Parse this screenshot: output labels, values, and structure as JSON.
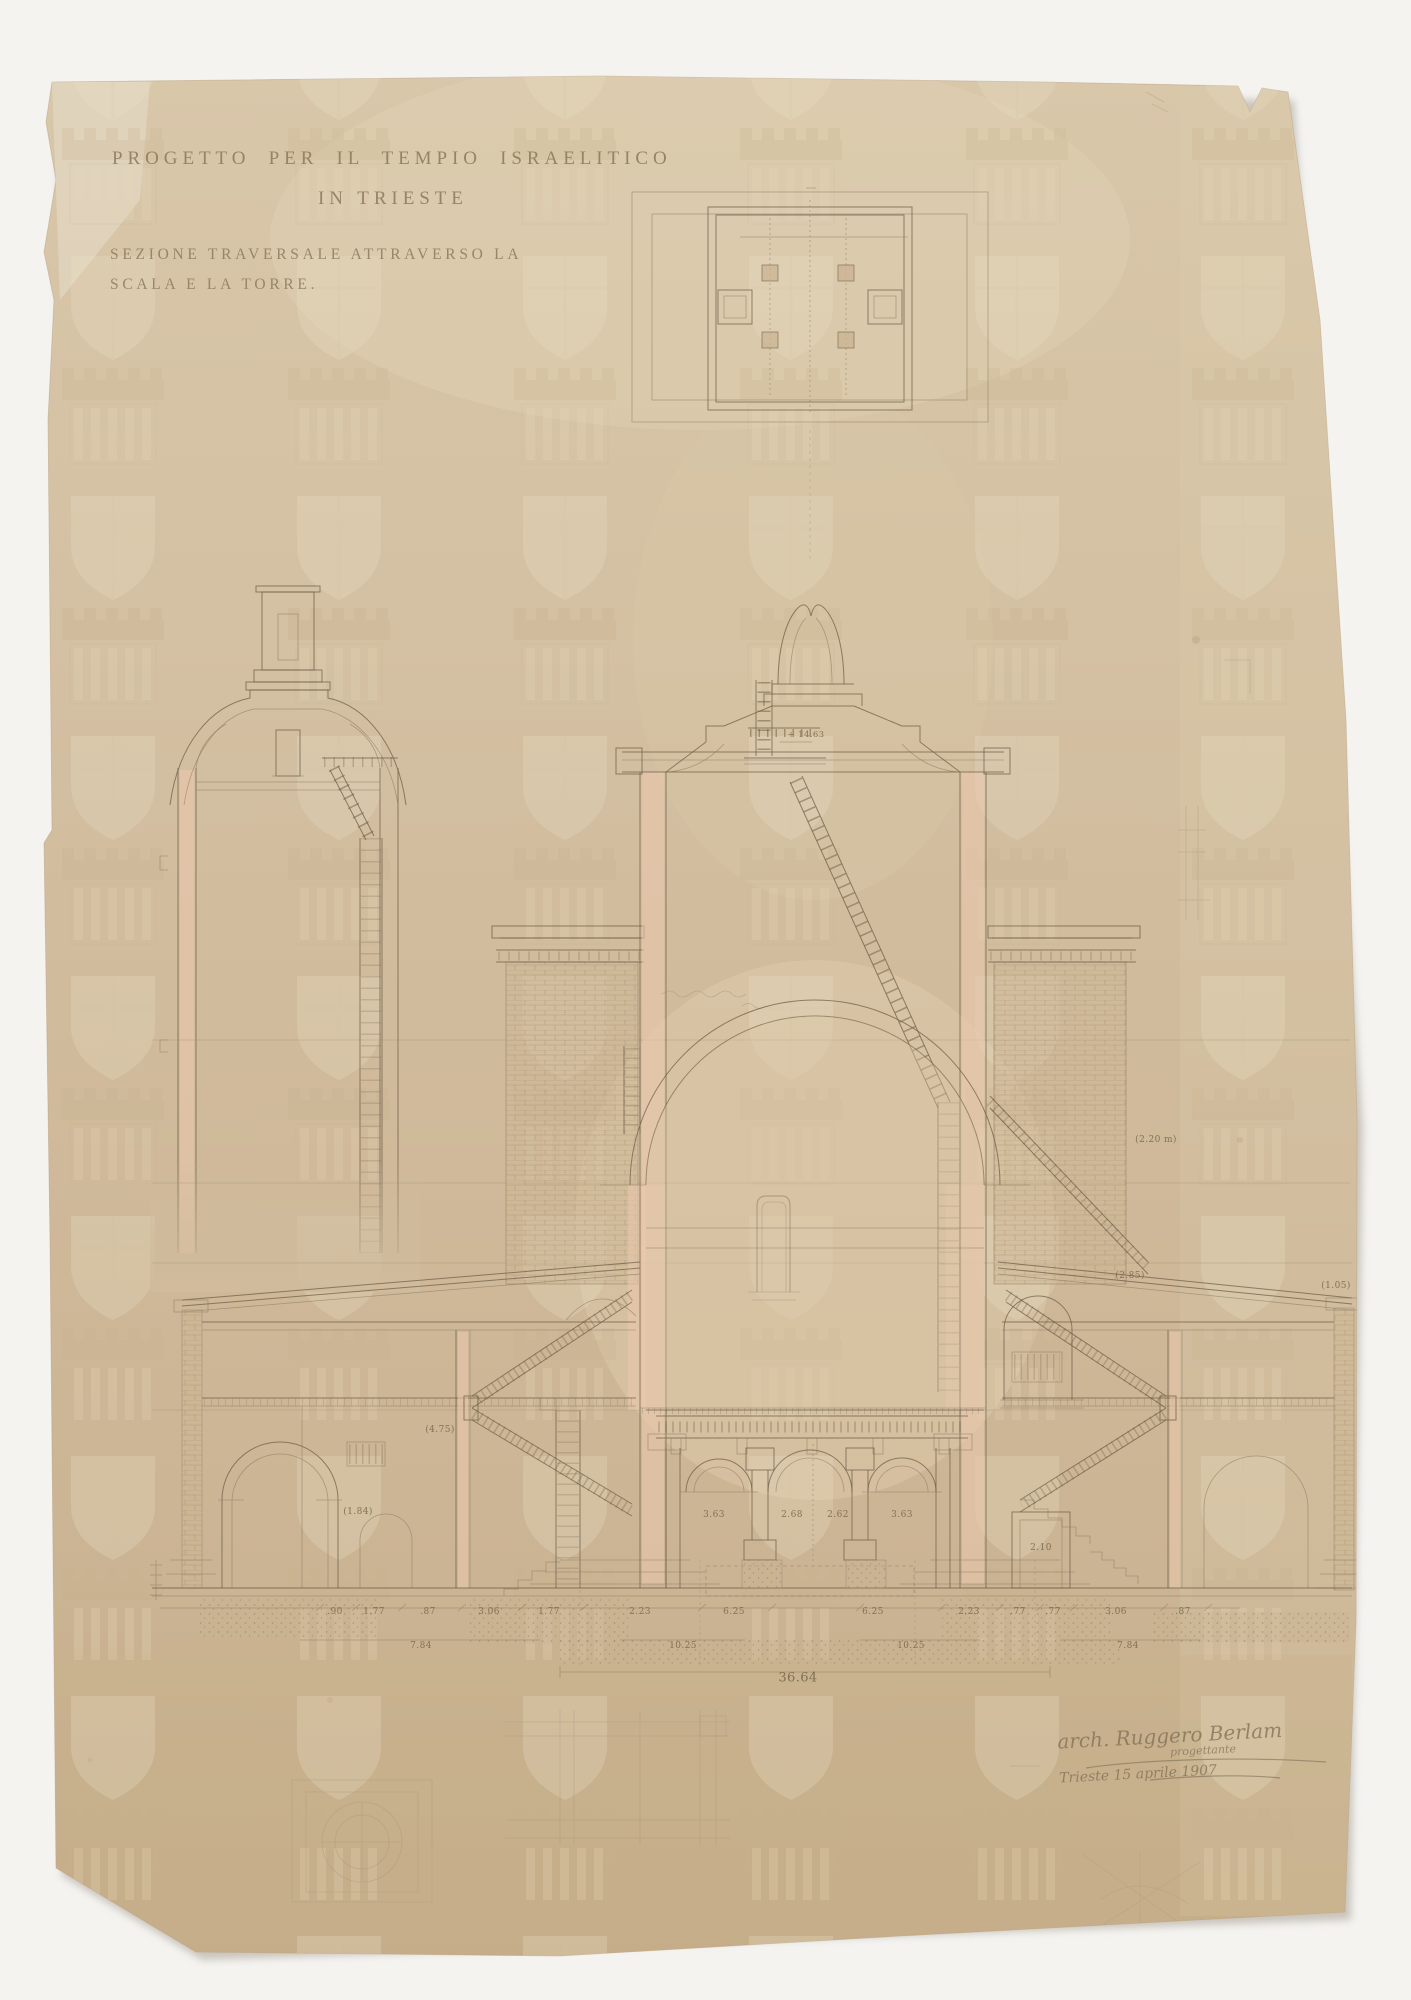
{
  "sheet": {
    "title_line1": "PROGETTO PER IL TEMPIO ISRAELITICO",
    "title_line2": "IN TRIESTE",
    "subtitle_line1": "SEZIONE TRAVERSALE ATTRAVERSO LA",
    "subtitle_line2": "SCALA E LA TORRE.",
    "signature": {
      "name": "arch. Ruggero Berlam",
      "qualifier": "progettante",
      "place_date": "Trieste 15 aprile 1907"
    }
  },
  "annotations": [
    {
      "t": "3.63",
      "x": 714,
      "y": 1515
    },
    {
      "t": "2.68",
      "x": 792,
      "y": 1515
    },
    {
      "t": "2.62",
      "x": 838,
      "y": 1515
    },
    {
      "t": "3.63",
      "x": 902,
      "y": 1515
    },
    {
      "t": "2.10",
      "x": 1041,
      "y": 1548
    },
    {
      "t": ".90",
      "x": 335,
      "y": 1612
    },
    {
      "t": "1.77",
      "x": 374,
      "y": 1612
    },
    {
      "t": ".87",
      "x": 428,
      "y": 1612
    },
    {
      "t": "3.06",
      "x": 489,
      "y": 1612
    },
    {
      "t": "1.77",
      "x": 549,
      "y": 1612
    },
    {
      "t": "2.23",
      "x": 640,
      "y": 1612
    },
    {
      "t": "6.25",
      "x": 734,
      "y": 1612
    },
    {
      "t": "6.25",
      "x": 873,
      "y": 1612
    },
    {
      "t": "2.23",
      "x": 969,
      "y": 1612
    },
    {
      "t": ".77",
      "x": 1018,
      "y": 1612
    },
    {
      "t": ".77",
      "x": 1053,
      "y": 1612
    },
    {
      "t": "3.06",
      "x": 1116,
      "y": 1612
    },
    {
      "t": ".87",
      "x": 1183,
      "y": 1612
    },
    {
      "t": "7.84",
      "x": 421,
      "y": 1646
    },
    {
      "t": "10.25",
      "x": 683,
      "y": 1646
    },
    {
      "t": "10.25",
      "x": 911,
      "y": 1646
    },
    {
      "t": "7.84",
      "x": 1128,
      "y": 1646
    },
    {
      "t": "36.64",
      "x": 798,
      "y": 1678,
      "s": 13
    },
    {
      "t": "+ 14.63",
      "x": 806,
      "y": 735,
      "s": 8.5
    },
    {
      "t": "(4.75)",
      "x": 440,
      "y": 1430
    },
    {
      "t": "(1.84)",
      "x": 358,
      "y": 1512
    },
    {
      "t": "(2.85)",
      "x": 1130,
      "y": 1276
    },
    {
      "t": "(2.20 m)",
      "x": 1156,
      "y": 1140
    },
    {
      "t": "(1.05)",
      "x": 1336,
      "y": 1286
    }
  ],
  "palette": {
    "background": "#f4f3f0",
    "paper": "#d1bc9e",
    "paper_edge": "#b79e7c",
    "ink": "#6f604a",
    "pencil": "#9d8e76",
    "pink_wash": "#ecc9ae",
    "brick": "#9f8a69"
  },
  "watermark": {
    "motif": "shield-and-battlement-watermark"
  }
}
